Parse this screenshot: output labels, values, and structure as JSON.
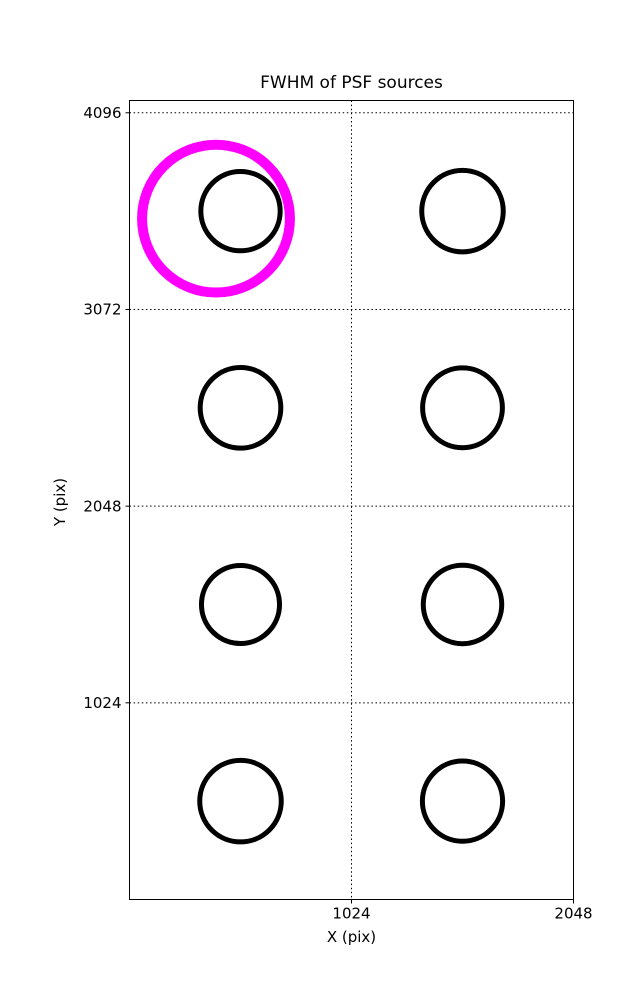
{
  "chart": {
    "title": "FWHM of PSF sources",
    "xlabel": "X (pix)",
    "ylabel": "Y (pix)"
  },
  "chart_data": {
    "type": "scatter",
    "title": "FWHM of PSF sources",
    "xlabel": "X (pix)",
    "ylabel": "Y (pix)",
    "xlim": [
      0,
      2048
    ],
    "ylim": [
      0,
      4160
    ],
    "xticks": [
      1024,
      2048
    ],
    "yticks": [
      1024,
      2048,
      3072,
      4096
    ],
    "grid": "dotted",
    "legend": "none",
    "frame": true,
    "background": "#FFFFFF",
    "series": [
      {
        "name": "psf-source-circles",
        "marker": "circle-outline",
        "color": "#000000",
        "stroke_width_px": 5,
        "points": [
          {
            "x": 512,
            "y": 3584,
            "r": 183
          },
          {
            "x": 1536,
            "y": 3584,
            "r": 188
          },
          {
            "x": 512,
            "y": 2560,
            "r": 186
          },
          {
            "x": 1536,
            "y": 2560,
            "r": 184
          },
          {
            "x": 512,
            "y": 1536,
            "r": 180
          },
          {
            "x": 1536,
            "y": 1536,
            "r": 181
          },
          {
            "x": 512,
            "y": 512,
            "r": 188
          },
          {
            "x": 1536,
            "y": 512,
            "r": 185
          }
        ]
      },
      {
        "name": "flagged-source-circle",
        "marker": "circle-outline",
        "color": "#FF00FF",
        "stroke_width_px": 10,
        "points": [
          {
            "x": 399,
            "y": 3545,
            "r": 341
          }
        ]
      }
    ]
  },
  "colors": {
    "foreground": "#000000",
    "highlight": "#FF00FF",
    "background": "#FFFFFF"
  }
}
